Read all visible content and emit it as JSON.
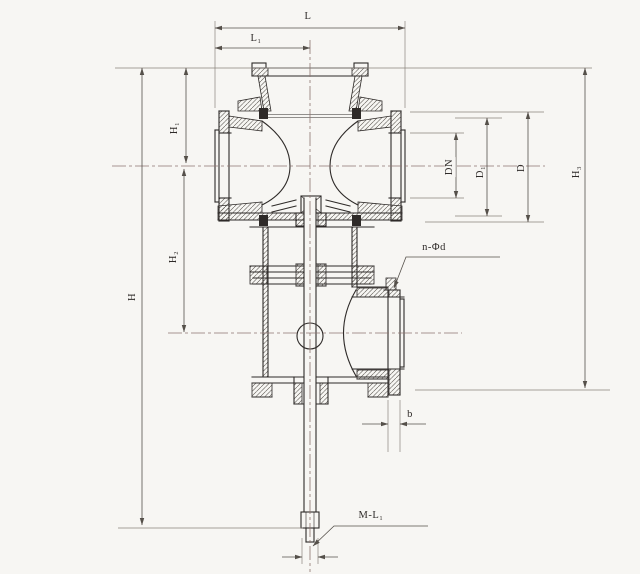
{
  "drawing": {
    "kind": "valve-sectional-technical-drawing",
    "labels": {
      "L": "L",
      "L1": "L₁",
      "H": "H",
      "H1": "H₁",
      "H2": "H₂",
      "DN": "DN",
      "D1": "D₁",
      "D": "D",
      "H3": "H₃",
      "n_phi_d": "n-Φd",
      "b": "b",
      "M_L1": "M-L₁"
    }
  },
  "colors": {
    "paper": "#f7f6f3",
    "outline": "#2e2a28",
    "dimension": "#55504a",
    "extension": "#8a837c",
    "centerline": "#8d7470",
    "hatch": "#4a4540"
  }
}
